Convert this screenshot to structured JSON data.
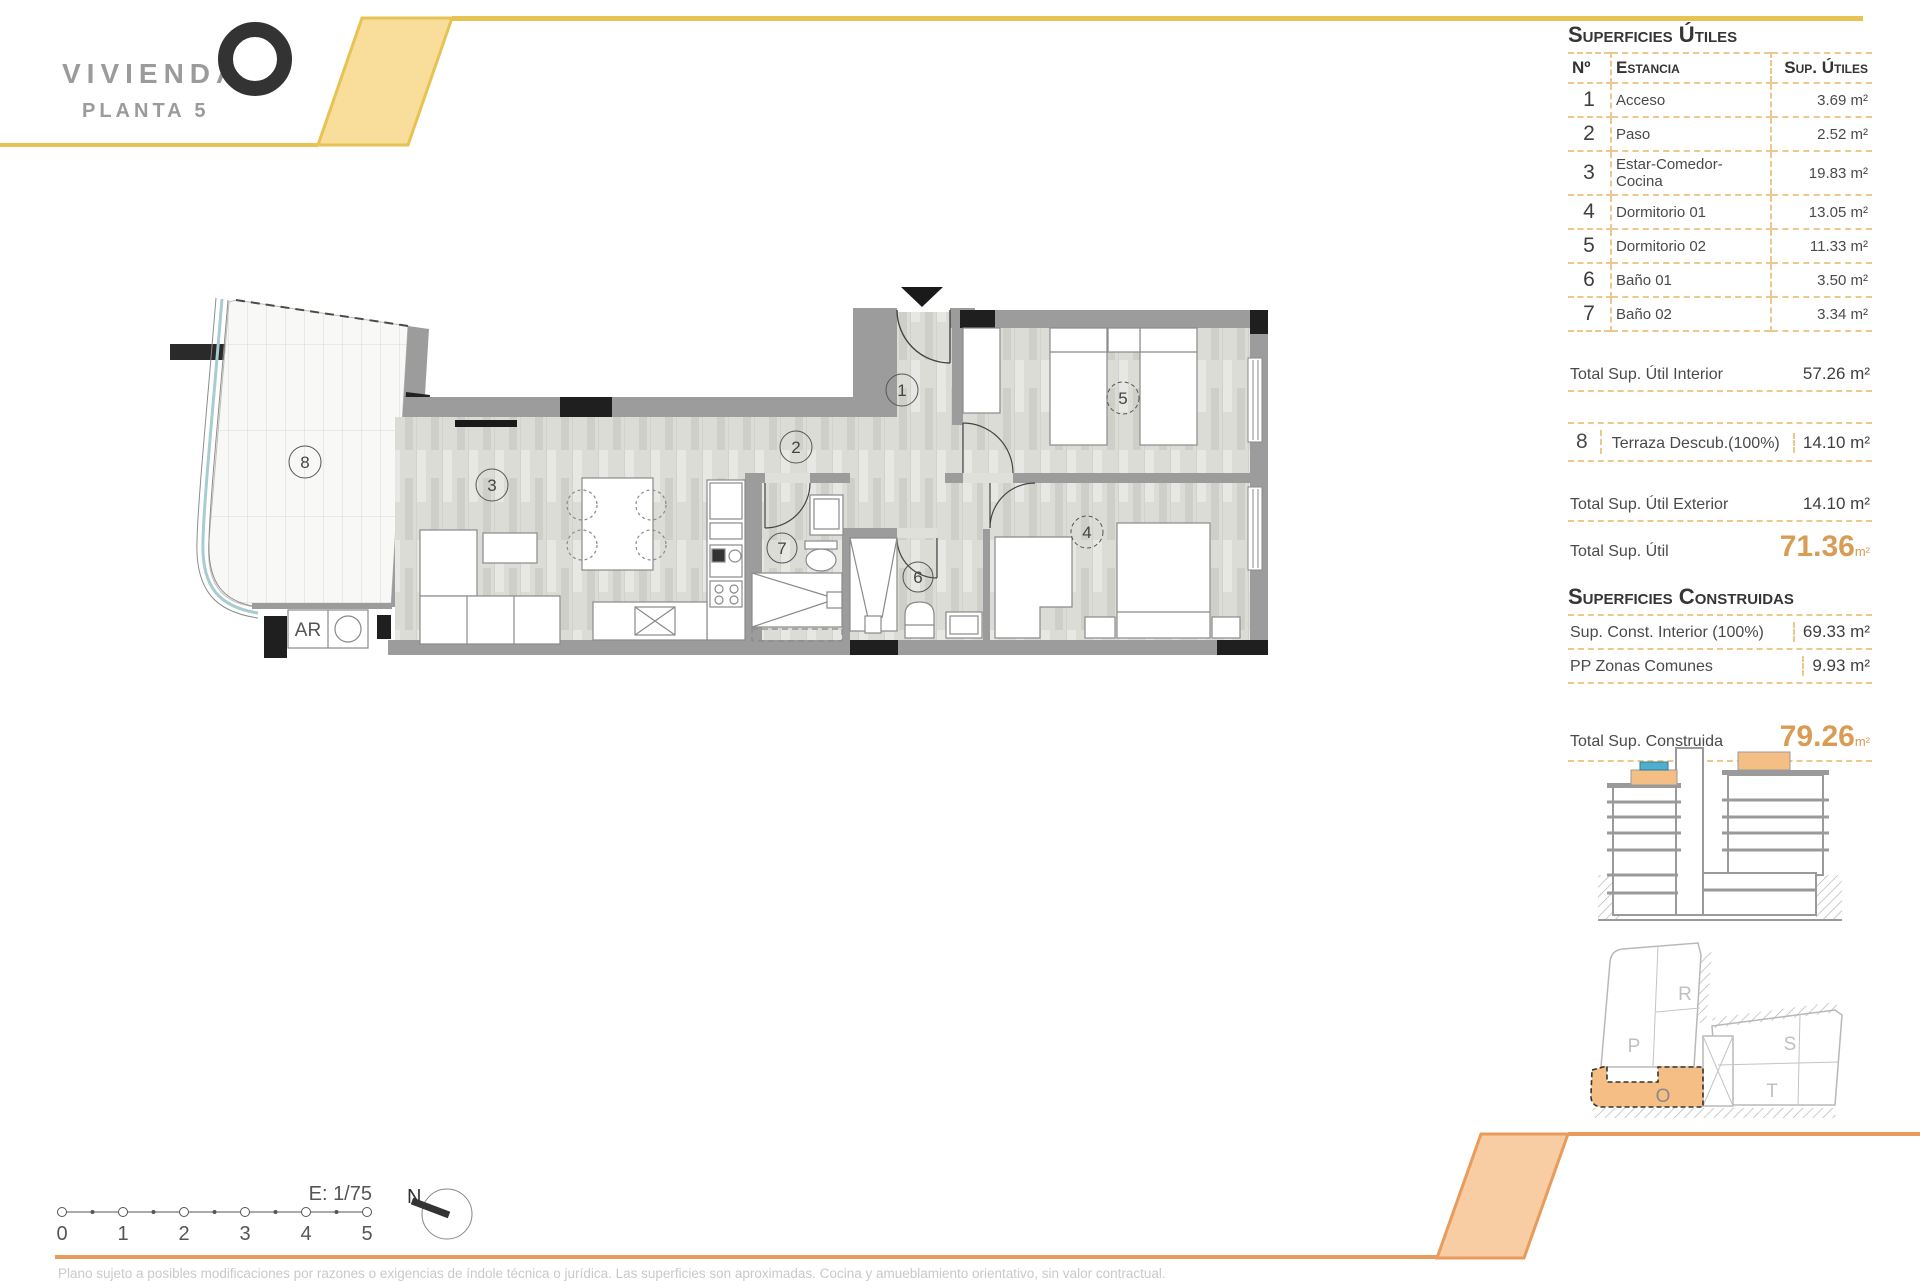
{
  "logo": {
    "brand": "VIVIENDA",
    "plan": "PLANTA 5"
  },
  "colors": {
    "header_yellow": "#E6C352",
    "header_fill": "#F8DE9A",
    "footer_orange": "#E89B5A",
    "footer_fill": "#F9CDA3",
    "accent_orange": "#D99C54",
    "dashed_border": "#ECC88E",
    "wall_gray": "#9C9C9C",
    "highlight_orange": "#F5BE85",
    "pool_blue": "#4FAECC"
  },
  "areas_table": {
    "title": "Superficies Útiles",
    "columns": {
      "no": "Nº",
      "room": "Estancia",
      "area": "Sup. Útiles"
    },
    "rows": [
      {
        "no": "1",
        "room": "Acceso",
        "area": "3.69 m²"
      },
      {
        "no": "2",
        "room": "Paso",
        "area": "2.52 m²"
      },
      {
        "no": "3",
        "room": "Estar-Comedor-Cocina",
        "area": "19.83 m²"
      },
      {
        "no": "4",
        "room": "Dormitorio 01",
        "area": "13.05 m²"
      },
      {
        "no": "5",
        "room": "Dormitorio 02",
        "area": "11.33 m²"
      },
      {
        "no": "6",
        "room": "Baño 01",
        "area": "3.50 m²"
      },
      {
        "no": "7",
        "room": "Baño 02",
        "area": "3.34 m²"
      }
    ]
  },
  "totals": {
    "interior_label": "Total Sup. Útil Interior",
    "interior_value": "57.26 m²",
    "terrace_no": "8",
    "terrace_label": "Terraza Descub.(100%)",
    "terrace_value": "14.10 m²",
    "exterior_label": "Total Sup. Útil Exterior",
    "exterior_value": "14.10 m²",
    "util_label": "Total Sup. Útil",
    "util_value": "71.36",
    "util_unit": "m²"
  },
  "built": {
    "title": "Superficies Construidas",
    "rows": [
      {
        "label": "Sup. Const. Interior (100%)",
        "value": "69.33 m²"
      },
      {
        "label": "PP Zonas Comunes",
        "value": "9.93 m²"
      }
    ],
    "total_label": "Total Sup. Construida",
    "total_value": "79.26",
    "total_unit": "m²"
  },
  "plan": {
    "rooms": {
      "r1": "1",
      "r2": "2",
      "r3": "3",
      "r4": "4",
      "r5": "5",
      "r6": "6",
      "r7": "7",
      "r8": "8"
    },
    "ar": "AR"
  },
  "site": {
    "p": "P",
    "r": "R",
    "s": "S",
    "t": "T",
    "o": "O"
  },
  "scalebar": {
    "scale": "E: 1/75",
    "north": "N",
    "ticks": [
      "0",
      "1",
      "2",
      "3",
      "4",
      "5"
    ]
  },
  "footer": {
    "disclaimer": "Plano sujeto a posibles modificaciones por razones o exigencias de índole técnica o jurídica. Las superficies son aproximadas. Cocina y amueblamiento orientativo, sin valor contractual."
  }
}
